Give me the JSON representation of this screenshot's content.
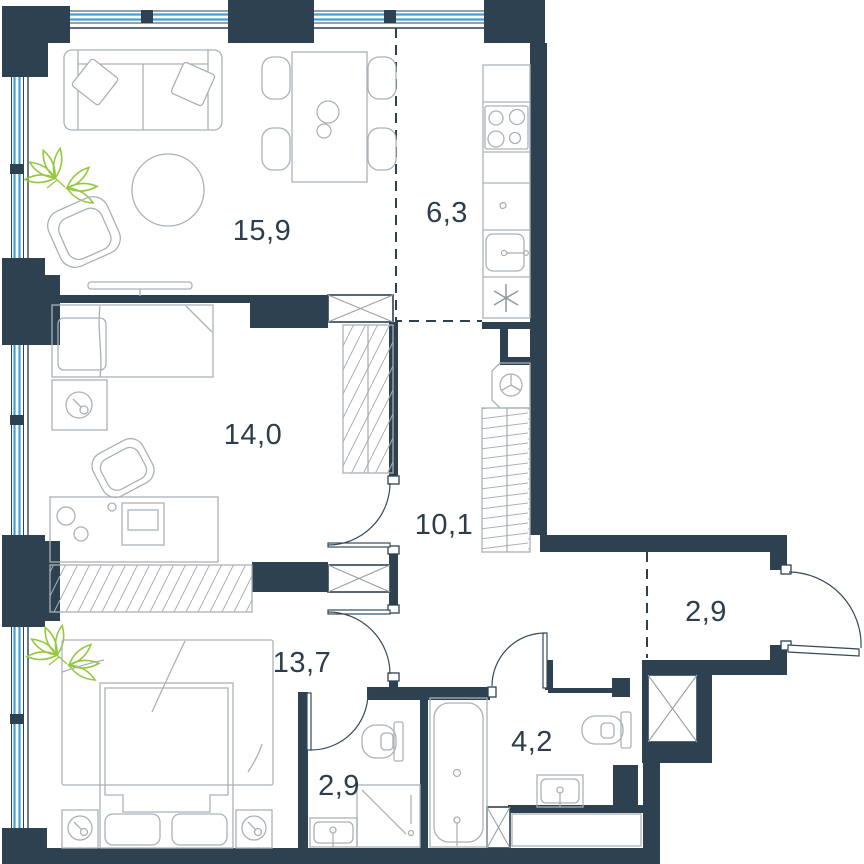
{
  "title": "Apartment floor plan",
  "plan": {
    "rooms": [
      {
        "name": "living-dining-room",
        "label": "15,9"
      },
      {
        "name": "kitchen",
        "label": "6,3"
      },
      {
        "name": "bedroom",
        "label": "14,0"
      },
      {
        "name": "corridor",
        "label": "10,1"
      },
      {
        "name": "entrance-hall",
        "label": "2,9"
      },
      {
        "name": "master-bedroom",
        "label": "13,7"
      },
      {
        "name": "shower-room",
        "label": "2,9"
      },
      {
        "name": "bathroom",
        "label": "4,2"
      }
    ],
    "colors": {
      "wall": "#2d4150",
      "window": "#3f9fd8",
      "plant_green": "#94c83d",
      "furniture_outline": "#a9b2b7",
      "label_text": "#2c3e4b",
      "background": "#ffffff"
    }
  }
}
